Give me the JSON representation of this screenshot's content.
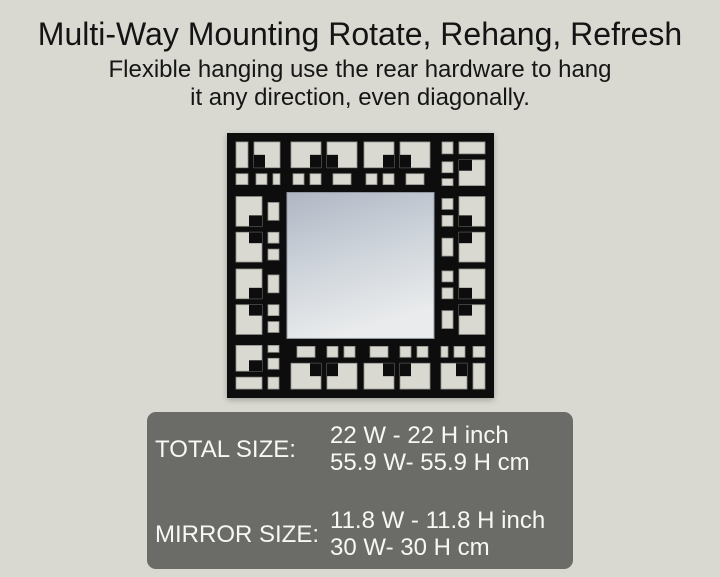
{
  "page": {
    "background": "#d9d9d2"
  },
  "header": {
    "title": "Multi-Way Mounting Rotate, Rehang, Refresh",
    "subtitle_line1": "Flexible hanging use the rear hardware to hang",
    "subtitle_line2": "it any direction, even diagonally."
  },
  "mirror": {
    "description": "square mirror with black geometric fretwork frame",
    "frame_color": "#0d0d0d",
    "cutout_color": "#d9d9d2",
    "glass_top": "#b0b7c4",
    "glass_mid": "#cdd3da",
    "glass_bottom": "#e9ebec"
  },
  "size_table": {
    "background": "#6b6b68",
    "text_color": "#f7f7f5",
    "rows": [
      {
        "label": "TOTAL SIZE:",
        "line1": "22 W - 22 H inch",
        "line2": "55.9 W- 55.9 H cm"
      },
      {
        "label": "MIRROR SIZE:",
        "line1": "11.8 W - 11.8 H inch",
        "line2": "30 W- 30 H cm"
      }
    ]
  }
}
